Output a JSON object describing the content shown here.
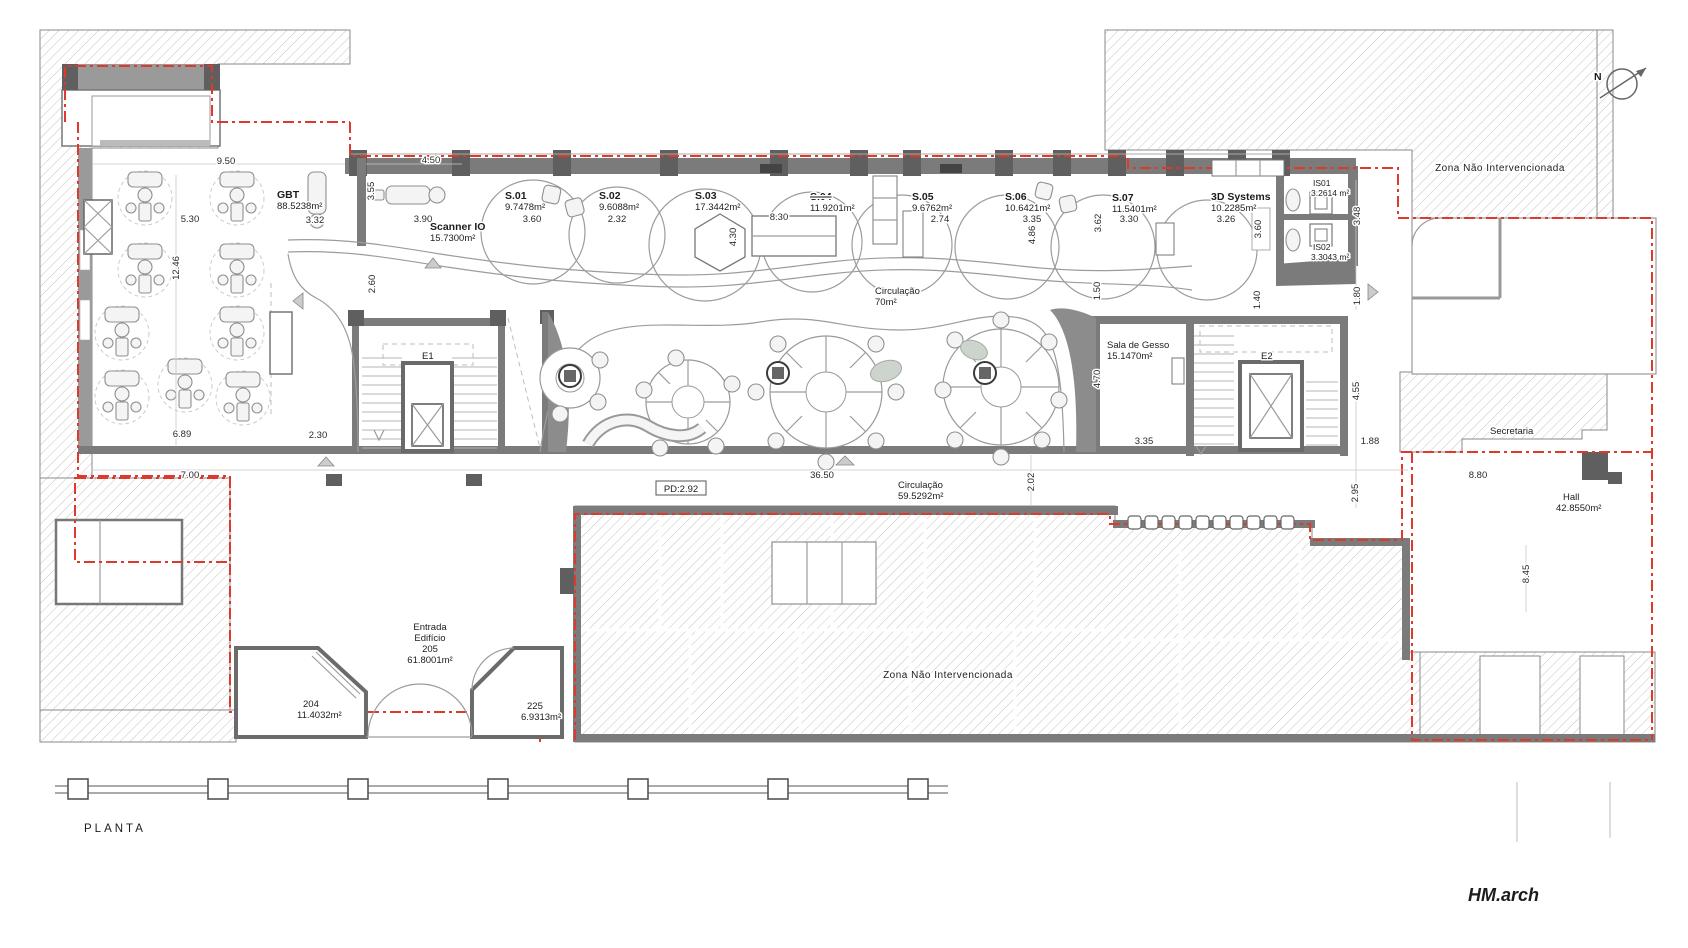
{
  "meta": {
    "drawing_label": "PLANTA",
    "firm": "HM.arch",
    "north": "N",
    "pd_height": "PD:2.92"
  },
  "colors": {
    "boundary_red": "#df382d",
    "wall_gray": "#7b7b7b",
    "hatch_gray": "#c4c4c4"
  },
  "rooms": {
    "gbt": {
      "name": "GBT",
      "area": "88.5238m²"
    },
    "scanner": {
      "name": "Scanner IO",
      "area": "15.7300m²"
    },
    "s01": {
      "name": "S.01",
      "area": "9.7478m²"
    },
    "s02": {
      "name": "S.02",
      "area": "9.6088m²"
    },
    "s03": {
      "name": "S.03",
      "area": "17.3442m²"
    },
    "s04": {
      "name": "S.04",
      "area": "11.9201m²"
    },
    "s05": {
      "name": "S.05",
      "area": "9.6762m²"
    },
    "s06": {
      "name": "S.06",
      "area": "10.6421m²"
    },
    "s07": {
      "name": "S.07",
      "area": "11.5401m²"
    },
    "systems3d": {
      "name": "3D Systems",
      "area": "10.2285m²"
    },
    "is01": {
      "name": "IS01",
      "area": "3.2614 m²"
    },
    "is02": {
      "name": "IS02",
      "area": "3.3043 m²"
    },
    "circulacao_top": {
      "name": "Circulação",
      "area": "70m²"
    },
    "gesso": {
      "name": "Sala de Gesso",
      "area": "15.1470m²"
    },
    "circulacao_main": {
      "name": "Circulação",
      "area": "59.5292m²"
    },
    "entrada": {
      "line1": "Entrada",
      "line2": "Edifício",
      "line3": "205",
      "area": "61.8001m²"
    },
    "r204": {
      "name": "204",
      "area": "11.4032m²"
    },
    "r225": {
      "name": "225",
      "area": "6.9313m²"
    },
    "hall": {
      "name": "Hall",
      "area": "42.8550m²"
    },
    "secretaria": {
      "name": "Secretaria"
    },
    "zona_top": {
      "name": "Zona Não Intervencionada"
    },
    "zona_bottom": {
      "name": "Zona Não Intervencionada"
    },
    "e1": {
      "name": "E1"
    },
    "e2": {
      "name": "E2"
    }
  },
  "dims": [
    "9.50",
    "4.50",
    "5.30",
    "3.32",
    "3.90",
    "3.55",
    "12.46",
    "2.60",
    "3.60",
    "2.32",
    "8.30",
    "4.30",
    "2.74",
    "3.35",
    "4.86",
    "3.62",
    "3.30",
    "3.26",
    "3.60",
    "1.50",
    "1.40",
    "1.80",
    "3.48",
    "4.70",
    "3.35",
    "6.89",
    "2.30",
    "7.00",
    "36.50",
    "2.02",
    "8.80",
    "1.88",
    "4.55",
    "2.95",
    "8.45"
  ]
}
